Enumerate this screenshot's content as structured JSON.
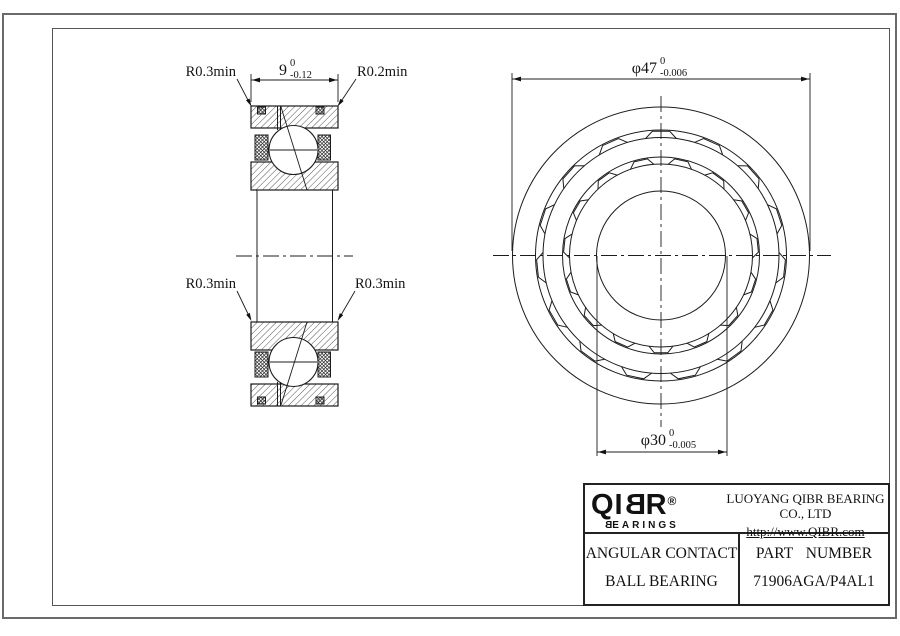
{
  "section_view": {
    "fillet_top_left": "R0.3min",
    "fillet_top_right": "R0.2min",
    "fillet_bottom_left": "R0.3min",
    "fillet_bottom_right": "R0.3min",
    "width_dim": {
      "nominal": "9",
      "upper": "0",
      "lower": "-0.12"
    }
  },
  "front_view": {
    "outer_dia_dim": {
      "nominal": "φ47",
      "upper": "0",
      "lower": "-0.006"
    },
    "bore_dia_dim": {
      "nominal": "φ30",
      "upper": "0",
      "lower": "-0.005"
    }
  },
  "title_block": {
    "logo": {
      "part1": "QI",
      "part2": "B",
      "part3": "R",
      "registered": "®",
      "sub1": "B",
      "sub2": "EARINGS"
    },
    "company": "LUOYANG QIBR BEARING CO., LTD",
    "website": "http://www.QIBR.com",
    "product_line1": "ANGULAR CONTACT",
    "product_line2": "BALL BEARING",
    "part_number_label": "PART NUMBER",
    "part_number": "71906AGA/P4AL1"
  }
}
